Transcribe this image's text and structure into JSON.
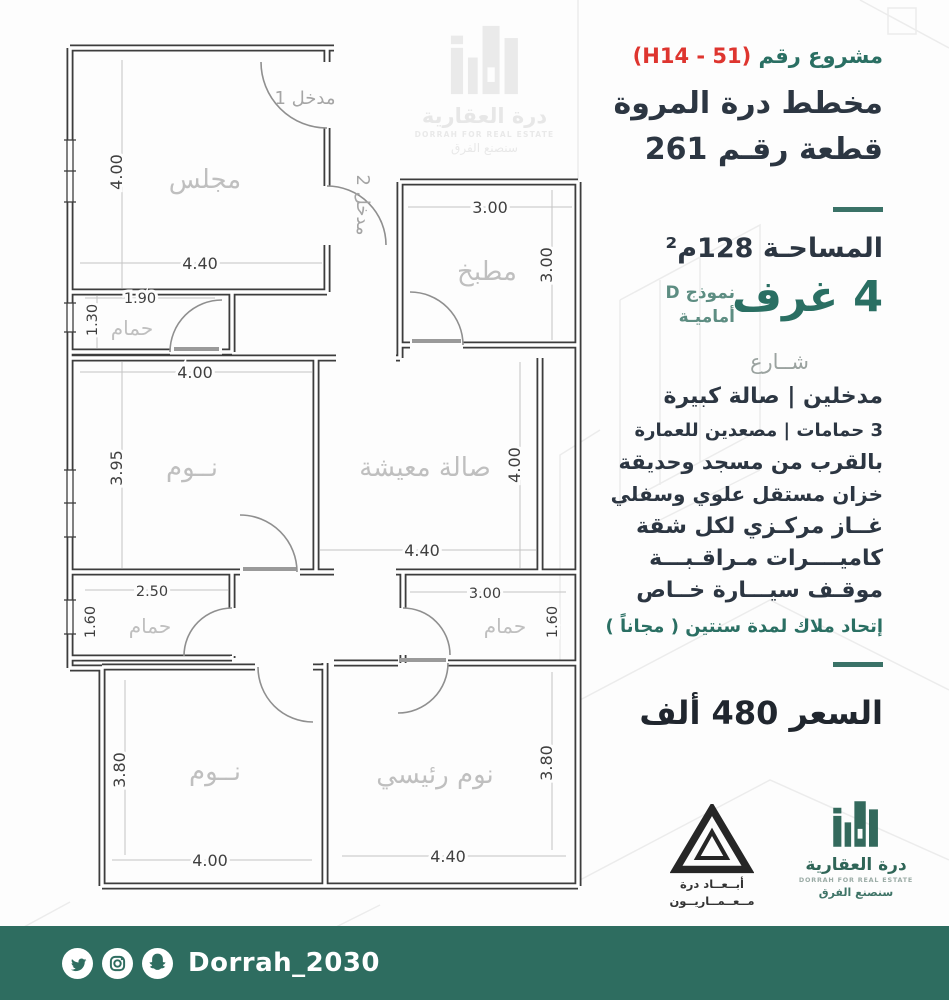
{
  "header": {
    "project_label": "مشروع رقم",
    "project_code": "(H14 - 51)",
    "line1": "مخطط درة المروة",
    "line2": "قطعة رقـم 261"
  },
  "specs": {
    "area": "المساحـة 128م²",
    "rooms_count": "4 غرف",
    "model": "نموذج D",
    "model_sub": "أماميـة",
    "street": "شــارع",
    "features": [
      "مدخلين   |   صالة كبيرة",
      "3 حمامات  |  مصعدين للعمارة",
      "بالقرب من مسجد وحديقة",
      "خزان مستقل علوي وسفلي",
      "غــاز مركـزي لكل شقة",
      "كاميــــرات مـراقـبـــة",
      "موقـف سيـــارة خــاص"
    ],
    "owners_union": "إتحاد ملاك لمدة سنتين ( مجاناً )",
    "price": "السعر 480 ألف"
  },
  "plan": {
    "entrance1": "مدخل 1",
    "entrance2": "مدخل 2",
    "rooms": {
      "majlis": {
        "label": "مجلس",
        "w": "4.40",
        "h": "4.00"
      },
      "kitchen": {
        "label": "مطبخ",
        "w": "3.00",
        "h": "3.00"
      },
      "bath_top": {
        "label": "حمام",
        "w": "1.90",
        "h": "1.30"
      },
      "bed_mid": {
        "label": "نــوم",
        "w": "4.00",
        "h": "3.95"
      },
      "living": {
        "label": "صالة معيشة",
        "w": "4.40",
        "h": "4.00"
      },
      "bath_left": {
        "label": "حمام",
        "w": "2.50",
        "h": "1.60"
      },
      "bath_right": {
        "label": "حمام",
        "w": "3.00",
        "h": "1.60"
      },
      "bed_bottom": {
        "label": "نــوم",
        "w": "4.00",
        "h": "3.80"
      },
      "master": {
        "label": "نوم رئيسي",
        "w": "4.40",
        "h": "3.80"
      }
    }
  },
  "watermark": {
    "brand_ar": "درة العقارية",
    "brand_en": "DORRAH FOR REAL ESTATE",
    "slogan": "سنصنع الفرق"
  },
  "logos": {
    "abaad": {
      "line1": "أبــعــاد درة",
      "line2": "مــعــمــاريــون"
    },
    "dorrah": {
      "brand_ar": "درة العقارية",
      "brand_en": "DORRAH FOR REAL ESTATE",
      "slogan": "سنصنع الفرق"
    }
  },
  "footer": {
    "handle": "Dorrah_2030"
  },
  "colors": {
    "teal": "#2a6f63",
    "red": "#de352f",
    "ink": "#2c3642",
    "banner": "#2e6d60"
  }
}
